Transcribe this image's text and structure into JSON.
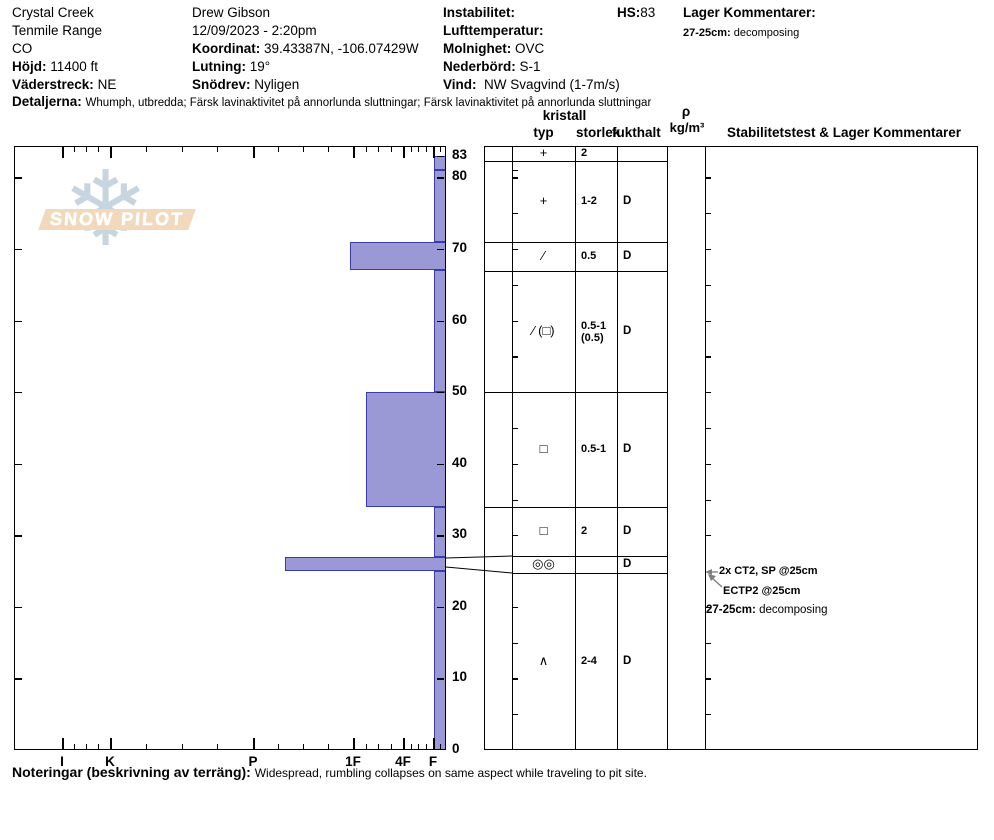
{
  "header": {
    "location": {
      "line1": "Crystal Creek",
      "line2": "Tenmile Range",
      "line3": "CO",
      "elevation_label": "Höjd:",
      "elevation": "11400 ft",
      "aspect_label": "Väderstreck:",
      "aspect": "NE"
    },
    "observer": {
      "name": "Drew Gibson",
      "datetime": "12/09/2023 - 2:20pm",
      "coordinates_label": "Koordinat:",
      "coordinates": "39.43387N, -106.07429W",
      "slope_label": "Lutning:",
      "slope": "19°",
      "snowdrift_label": "Snödrev:",
      "snowdrift": "Nyligen"
    },
    "conditions": {
      "instability_label": "Instabilitet:",
      "instability": "",
      "airtemp_label": "Lufttemperatur:",
      "airtemp": "",
      "sky_label": "Molnighet:",
      "sky": "OVC",
      "precip_label": "Nederbörd:",
      "precip": "S-1",
      "wind_label": "Vind:",
      "wind": "NW Svagvind (1-7m/s)"
    },
    "hs_label": "HS:",
    "hs_value": "83",
    "layer_comments_label": "Lager Kommentarer:",
    "layer_comment_depth": "27-25cm:",
    "layer_comment_text": "decomposing",
    "details_label": "Detaljerna:",
    "details_text": "Whumph, utbredda;  Färsk lavinaktivitet på annorlunda sluttningar;  Färsk lavinaktivitet på annorlunda sluttningar"
  },
  "logo": {
    "text": "SNOW PILOT",
    "snowflake_icon": "❄"
  },
  "chart_data": {
    "type": "bar",
    "title": "Snow profile: hand hardness vs depth (cm)",
    "depth_unit": "cm",
    "total_depth_hs": 83,
    "depth_ticks": [
      83,
      80,
      70,
      60,
      50,
      40,
      30,
      20,
      10,
      0
    ],
    "hardness_labels": [
      "I",
      "K",
      "P",
      "1F",
      "4F",
      "F"
    ],
    "layers": [
      {
        "depth_top": 83,
        "depth_bottom": 81,
        "hardness": "F",
        "grain_type": "+",
        "grain_size": "2",
        "moisture": ""
      },
      {
        "depth_top": 81,
        "depth_bottom": 71,
        "hardness": "F",
        "grain_type": "+",
        "grain_size": "1-2",
        "moisture": "D"
      },
      {
        "depth_top": 71,
        "depth_bottom": 67,
        "hardness": "1F",
        "grain_type": "∕",
        "grain_size": "0.5",
        "moisture": "D"
      },
      {
        "depth_top": 67,
        "depth_bottom": 50,
        "hardness": "F",
        "grain_type": "∕ (□)",
        "grain_size": "0.5-1\n(0.5)",
        "moisture": "D"
      },
      {
        "depth_top": 50,
        "depth_bottom": 34,
        "hardness": "1F-",
        "grain_type": "□",
        "grain_size": "0.5-1",
        "moisture": "D"
      },
      {
        "depth_top": 34,
        "depth_bottom": 27,
        "hardness": "F",
        "grain_type": "□",
        "grain_size": "2",
        "moisture": "D"
      },
      {
        "depth_top": 27,
        "depth_bottom": 25,
        "hardness": "P-",
        "grain_type": "◎◎",
        "grain_size": "",
        "moisture": "D"
      },
      {
        "depth_top": 25,
        "depth_bottom": 0,
        "hardness": "F",
        "grain_type": "∧",
        "grain_size": "2-4",
        "moisture": "D"
      }
    ],
    "bar_fill": "#9a99d6",
    "bar_border": "#3b3bb0"
  },
  "profile_table": {
    "kristall_header": "kristall",
    "typ_header": "typ",
    "storlek_header": "storlek",
    "fukthalt_header": "fukthalt",
    "rho_header": "ρ",
    "rho_unit": "kg/m³",
    "stability_header": "Stabilitetstest & Lager Kommentarer"
  },
  "stability_tests": {
    "test1": "2x CT2, SP @25cm",
    "test2": "ECTP2 @25cm",
    "layer_comment_depth": "27-25cm:",
    "layer_comment_text": "decomposing"
  },
  "footer": {
    "label": "Noteringar (beskrivning av terräng):",
    "text": "Widespread, rumbling collapses on same aspect while traveling to pit site."
  }
}
